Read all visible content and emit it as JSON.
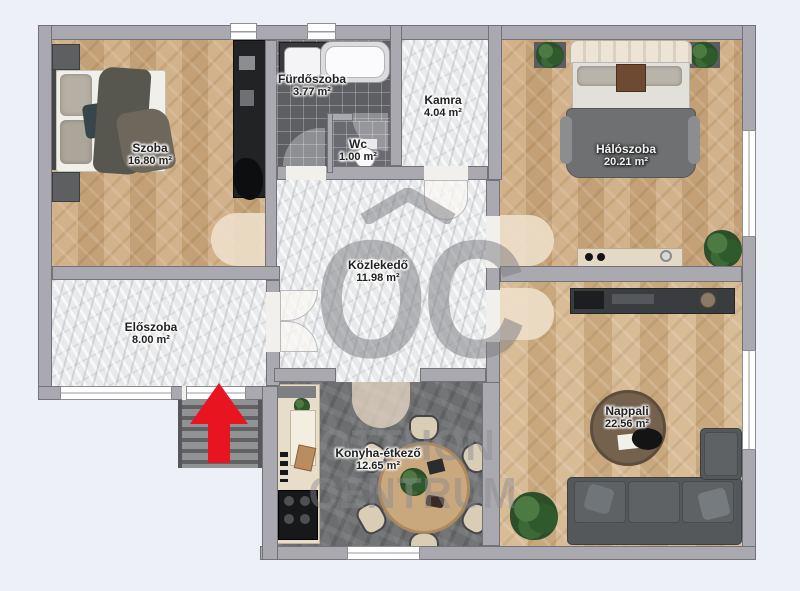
{
  "plan": {
    "rooms": {
      "szoba": {
        "name": "Szoba",
        "area": "16.80 m²"
      },
      "furdoszoba": {
        "name": "Fürdőszoba",
        "area": "3.77 m²"
      },
      "wc": {
        "name": "Wc",
        "area": "1.00 m²"
      },
      "kamra": {
        "name": "Kamra",
        "area": "4.04 m²"
      },
      "haloszoba": {
        "name": "Hálószoba",
        "area": "20.21 m²"
      },
      "kozlekedo": {
        "name": "Közlekedő",
        "area": "11.98 m²"
      },
      "eloszoba": {
        "name": "Előszoba",
        "area": "8.00 m²"
      },
      "konyha": {
        "name": "Konyha-étkező",
        "area": "12.65 m²"
      },
      "nappali": {
        "name": "Nappali",
        "area": "22.56 m²"
      }
    },
    "watermark": {
      "logo": "OC",
      "line1": "OTTHON",
      "line2": "CENTRUM"
    },
    "colors": {
      "arrow": "#e8141f",
      "wall": "#a9a9af",
      "background": "#edf0f6"
    }
  }
}
